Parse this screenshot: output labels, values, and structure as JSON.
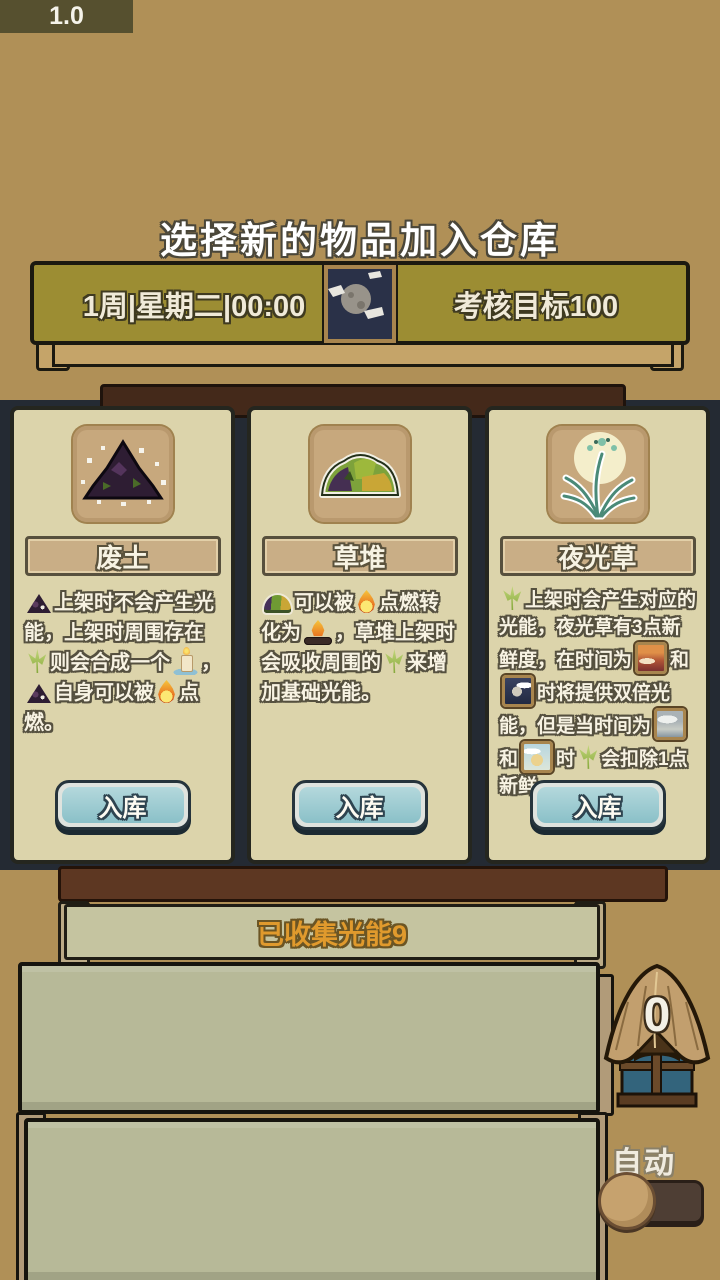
{
  "app": {
    "version_label": "1.0"
  },
  "header": {
    "title": "选择新的物品加入仓库",
    "time_banner": {
      "datetime": "1周|星期二|00:00",
      "goal": "考核目标100",
      "center_icon": "moon-night-icon"
    }
  },
  "cards": [
    {
      "name": "废土",
      "icon": "waste-dirt-icon",
      "button": "入库",
      "desc": [
        {
          "icon": "dirt-pile-icon"
        },
        {
          "text": "上架时不会产生光能，上架时周围存在"
        },
        {
          "icon": "sprout-icon"
        },
        {
          "text": "则会合成一个"
        },
        {
          "icon": "candle-icon"
        },
        {
          "text": "，"
        },
        {
          "icon": "dirt-pile-icon"
        },
        {
          "text": "自身可以被"
        },
        {
          "icon": "fire-icon"
        },
        {
          "text": "点燃。"
        }
      ]
    },
    {
      "name": "草堆",
      "icon": "grass-pile-icon",
      "button": "入库",
      "desc": [
        {
          "icon": "grass-pile-icon"
        },
        {
          "text": "可以被"
        },
        {
          "icon": "fire-icon"
        },
        {
          "text": "点燃转化为"
        },
        {
          "icon": "campfire-icon"
        },
        {
          "text": "，草堆上架时会吸收周围的"
        },
        {
          "icon": "sprout-icon"
        },
        {
          "text": "来增加基础光能。"
        }
      ]
    },
    {
      "name": "夜光草",
      "icon": "night-grass-icon",
      "button": "入库",
      "desc": [
        {
          "icon": "sprout-icon"
        },
        {
          "text": "上架时会产生对应的光能，夜光草有3点新鲜度，在时间为"
        },
        {
          "icon": "weather-dusk-icon"
        },
        {
          "text": "和"
        },
        {
          "icon": "weather-night-icon"
        },
        {
          "text": "时将提供双倍光能，但是当时间为"
        },
        {
          "icon": "weather-rain-icon"
        },
        {
          "text": "和"
        },
        {
          "icon": "weather-day-icon"
        },
        {
          "text": "时"
        },
        {
          "icon": "sprout-icon"
        },
        {
          "text": "会扣除1点新鲜"
        }
      ]
    }
  ],
  "collected_banner": {
    "label": "已收集光能9"
  },
  "storage_hut": {
    "count": "0",
    "icon": "thatched-hut-icon"
  },
  "auto_toggle": {
    "label": "自动",
    "state": "off"
  },
  "colors": {
    "background": "#b09057",
    "banner_olive": "#9c8d33",
    "card_parchment": "#dcd4ab",
    "button_blue": "#8ac0c8",
    "accent_orange": "#e09a2d",
    "wood_dark": "#44291a",
    "shelf_sage": "#b7b998"
  }
}
